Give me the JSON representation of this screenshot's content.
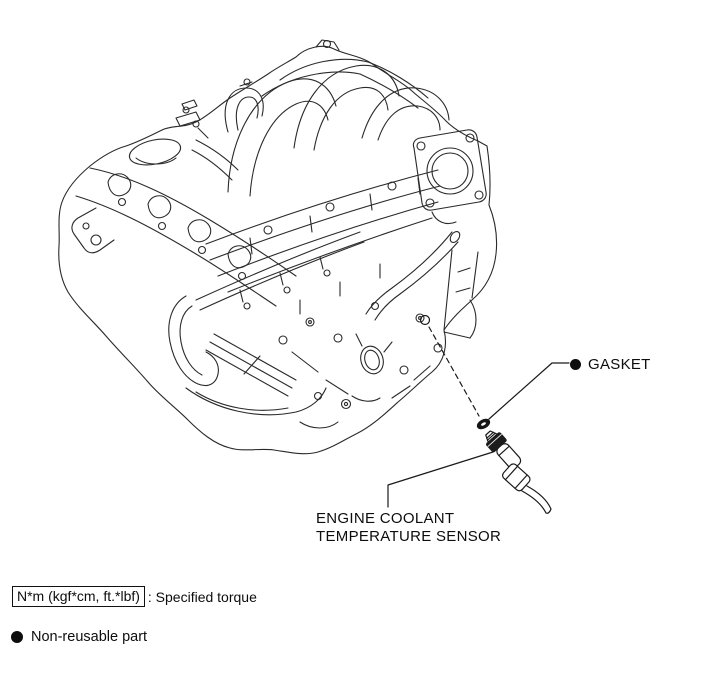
{
  "page": {
    "background": "#ffffff",
    "line_color": "#2a2a2a",
    "text_color": "#0d0d0d"
  },
  "figure": {
    "description": "Isometric line illustration of V6 engine with exploded view of coolant temperature sensor",
    "callouts": {
      "gasket": {
        "symbol": "●",
        "label": "GASKET"
      },
      "sensor": {
        "line1": "ENGINE COOLANT",
        "line2": "TEMPERATURE SENSOR"
      }
    }
  },
  "legend": {
    "torque": {
      "boxed_text": "N*m (kgf*cm, ft.*lbf)",
      "suffix": ": Specified torque"
    },
    "non_reusable": {
      "symbol": "●",
      "text": "Non-reusable part"
    }
  }
}
